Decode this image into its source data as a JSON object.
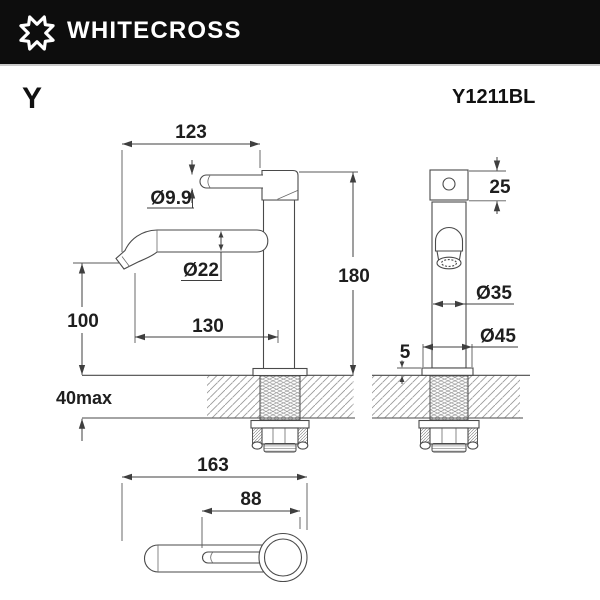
{
  "header": {
    "brand": "WHITECROSS",
    "logo": "whitecross-x-icon"
  },
  "product": {
    "series": "Y",
    "model": "Y1211BL"
  },
  "drawing": {
    "dimensions": {
      "side_view": {
        "spout_reach": "123",
        "handle_diameter": "Ø9.9",
        "spout_diameter": "Ø22",
        "spout_projection": "130",
        "outlet_height": "100",
        "deck_thickness_max": "40max",
        "total_height": "180"
      },
      "front_view": {
        "cap_height": "25",
        "body_diameter": "Ø35",
        "flange_diameter": "Ø45",
        "flange_thickness": "5"
      },
      "top_view": {
        "overall_length": "163",
        "handle_length": "88"
      }
    }
  },
  "colors": {
    "header_bg": "#0d0d0d",
    "line": "#4a4a4a",
    "dimension_text": "#1e1e1e",
    "hatch": "#9a9a9a"
  }
}
